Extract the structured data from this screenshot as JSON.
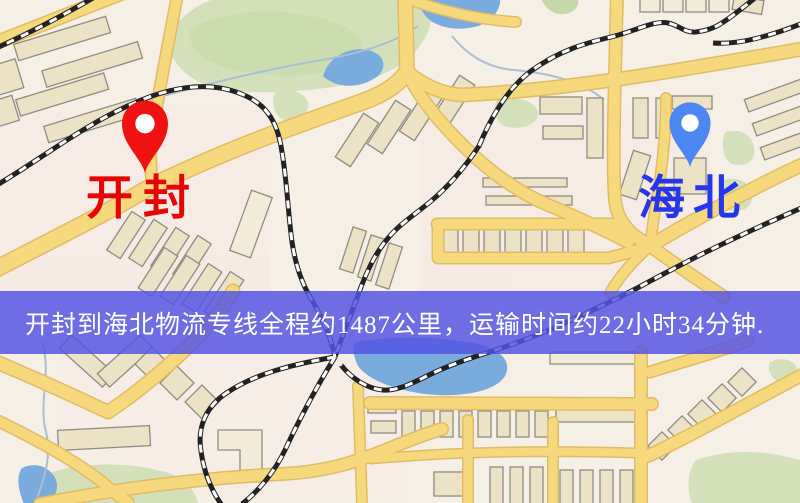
{
  "banner": {
    "text": "开封到海北物流专线全程约1487公里，运输时间约22小时34分钟.",
    "distance_text": "约1487公里",
    "duration_text": "约22小时34分钟",
    "background": "rgba(84,84,228,0.84)",
    "text_color": "#ffffff"
  },
  "markers": {
    "origin": {
      "label": "开封",
      "pin_color": "#f01111",
      "label_color": "#e60404"
    },
    "destination": {
      "label": "海北",
      "pin_color": "#4d87f2",
      "label_color": "#2636ea"
    }
  },
  "map_colors": {
    "background": "#f6efe6",
    "road": "#f6d97d",
    "road_casing": "#e3bb66",
    "building": "#ece2c6",
    "park": "#d3e0ba",
    "water": "#79abdc",
    "railway": "#222222"
  }
}
